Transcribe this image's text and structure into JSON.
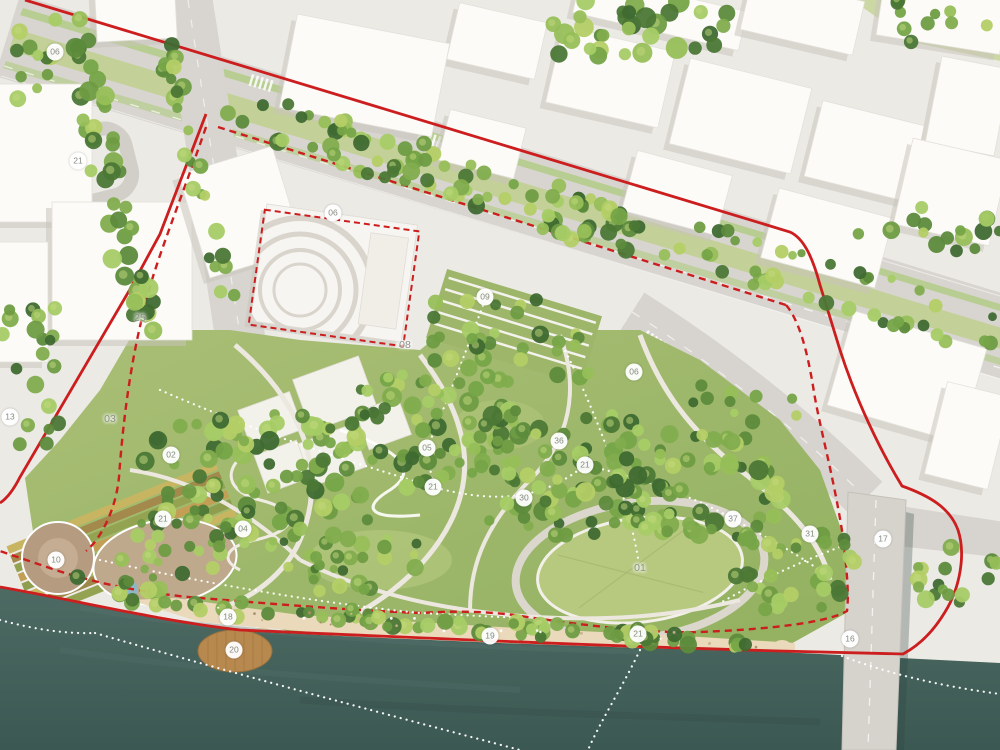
{
  "plan": {
    "kind": "riverfront-park-masterplan-aerial-rendering",
    "colors": {
      "boundary_red": "#cc1e1e",
      "water": "#45615b",
      "park_green": "#9fb96b",
      "tree_green": "#6f9c43",
      "street_gray": "#d8d5d0",
      "building_white": "#fbfaf7",
      "sand_beach": "#ead9ba",
      "wood_platform": "#b8894f",
      "marker_background": "#ffffff",
      "marker_text": "#868b80"
    },
    "markers": [
      {
        "label": "06",
        "x": 55,
        "y": 52,
        "kind": "circle"
      },
      {
        "label": "21",
        "x": 78,
        "y": 161,
        "kind": "circle"
      },
      {
        "label": "06",
        "x": 333,
        "y": 213,
        "kind": "circle"
      },
      {
        "label": "09",
        "x": 485,
        "y": 297,
        "kind": "circle"
      },
      {
        "label": "08",
        "x": 405,
        "y": 345,
        "kind": "text"
      },
      {
        "label": "25",
        "x": 140,
        "y": 318,
        "kind": "text"
      },
      {
        "label": "13",
        "x": 10,
        "y": 417,
        "kind": "circle"
      },
      {
        "label": "03",
        "x": 110,
        "y": 419,
        "kind": "text"
      },
      {
        "label": "02",
        "x": 171,
        "y": 455,
        "kind": "circle"
      },
      {
        "label": "21",
        "x": 163,
        "y": 519,
        "kind": "circle"
      },
      {
        "label": "04",
        "x": 243,
        "y": 529,
        "kind": "circle"
      },
      {
        "label": "10",
        "x": 56,
        "y": 560,
        "kind": "circle"
      },
      {
        "label": "18",
        "x": 228,
        "y": 617,
        "kind": "circle"
      },
      {
        "label": "20",
        "x": 234,
        "y": 650,
        "kind": "circle"
      },
      {
        "label": "05",
        "x": 427,
        "y": 448,
        "kind": "circle"
      },
      {
        "label": "21",
        "x": 433,
        "y": 487,
        "kind": "circle"
      },
      {
        "label": "36",
        "x": 559,
        "y": 441,
        "kind": "circle"
      },
      {
        "label": "21",
        "x": 585,
        "y": 465,
        "kind": "circle"
      },
      {
        "label": "30",
        "x": 524,
        "y": 498,
        "kind": "circle"
      },
      {
        "label": "01",
        "x": 640,
        "y": 568,
        "kind": "text"
      },
      {
        "label": "06",
        "x": 634,
        "y": 372,
        "kind": "circle"
      },
      {
        "label": "37",
        "x": 733,
        "y": 519,
        "kind": "circle"
      },
      {
        "label": "31",
        "x": 810,
        "y": 534,
        "kind": "circle"
      },
      {
        "label": "17",
        "x": 883,
        "y": 539,
        "kind": "circle"
      },
      {
        "label": "16",
        "x": 850,
        "y": 639,
        "kind": "circle"
      },
      {
        "label": "19",
        "x": 490,
        "y": 636,
        "kind": "circle"
      },
      {
        "label": "21",
        "x": 638,
        "y": 634,
        "kind": "circle"
      }
    ]
  }
}
